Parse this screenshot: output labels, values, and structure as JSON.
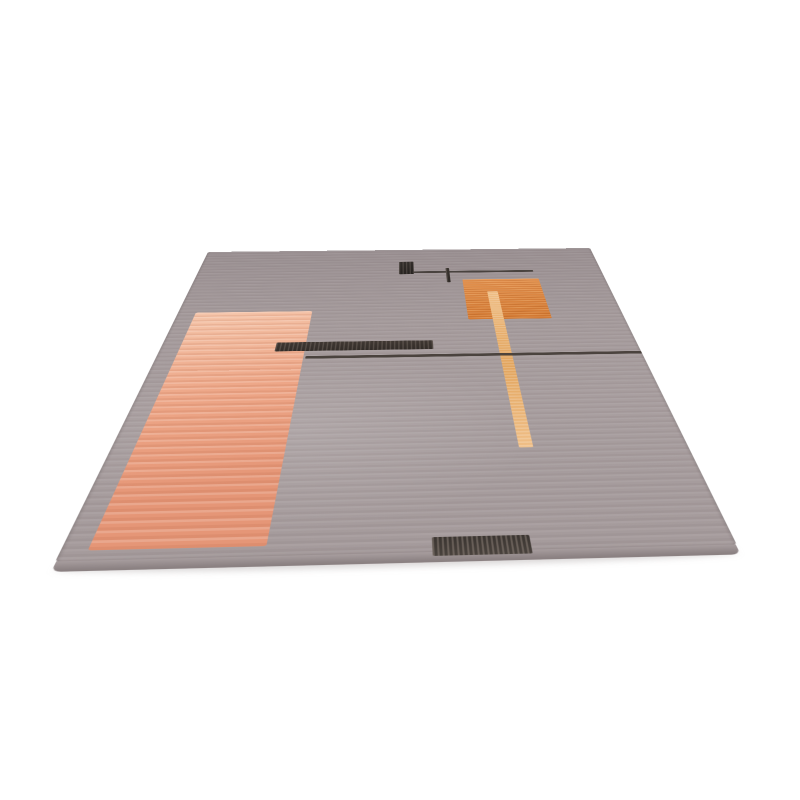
{
  "meta": {
    "subject": "Product photo of a grey modern area rug with abstract geometric pattern (salmon field, orange block, gold stripe, charcoal bars), lying flat in perspective on a white background"
  },
  "canvas": {
    "width": 800,
    "height": 800,
    "background": "#ffffff"
  },
  "rug": {
    "plane": {
      "width": 680,
      "height": 960
    },
    "quad": {
      "back_left": [
        208,
        252
      ],
      "back_right": [
        590,
        248
      ],
      "front_left": [
        55,
        562
      ],
      "front_right": [
        737,
        545
      ]
    },
    "base": {
      "far": "#9a9092",
      "mid": "#a59b9c",
      "near": "#a89e9f"
    },
    "elements": [
      {
        "name": "floor-shadow",
        "kind": "shadow",
        "rect": [
          1.0,
          99.8,
          98.0,
          2.6
        ],
        "colors": [
          "rgba(130,120,120,0.30)"
        ]
      },
      {
        "name": "rug-pile-front-edge",
        "kind": "pile",
        "rect": [
          0.2,
          99.9,
          99.6,
          1.9
        ],
        "colors": [
          "#a79d9e",
          "#8b8182"
        ]
      },
      {
        "name": "salmon-field",
        "kind": "salmon",
        "rect": [
          4.0,
          30.5,
          26.0,
          67.5
        ],
        "colors": [
          "#f5c6ab",
          "#eda687",
          "#e59677"
        ]
      },
      {
        "name": "orange-block",
        "kind": "orange",
        "rect": [
          65.0,
          16.5,
          18.7,
          18.5
        ],
        "colors": [
          "#e2914f",
          "#d47a33"
        ]
      },
      {
        "name": "gold-stripe",
        "kind": "gold",
        "rect": [
          70.5,
          22.5,
          2.4,
          55.0
        ],
        "colors": [
          "#efbe86",
          "#e2a55e"
        ]
      },
      {
        "name": "dark-square",
        "kind": "dark",
        "rect": [
          49.5,
          6.8,
          3.8,
          6.6
        ],
        "colors": [
          "#332e2b",
          "#272320"
        ]
      },
      {
        "name": "top-rule-line",
        "kind": "darkline",
        "rect": [
          53.0,
          12.0,
          30.0,
          0.9
        ],
        "colors": [
          "#443e3a"
        ]
      },
      {
        "name": "tick-mark",
        "kind": "dark",
        "rect": [
          61.2,
          10.4,
          0.85,
          7.4
        ],
        "colors": [
          "#3a342f",
          "#2e2925"
        ]
      },
      {
        "name": "mid-thick-bar",
        "kind": "dark",
        "rect": [
          23.8,
          43.2,
          33.0,
          3.4
        ],
        "colors": [
          "#403833",
          "#322c28"
        ]
      },
      {
        "name": "mid-long-line",
        "kind": "darkline",
        "rect": [
          30.5,
          48.4,
          69.5,
          1.0
        ],
        "colors": [
          "#463e39"
        ]
      },
      {
        "name": "front-dark-patch",
        "kind": "patch",
        "rect": [
          54.6,
          97.1,
          14.6,
          3.5
        ],
        "colors": [
          "#3b3531",
          "#4a433e"
        ]
      }
    ]
  }
}
